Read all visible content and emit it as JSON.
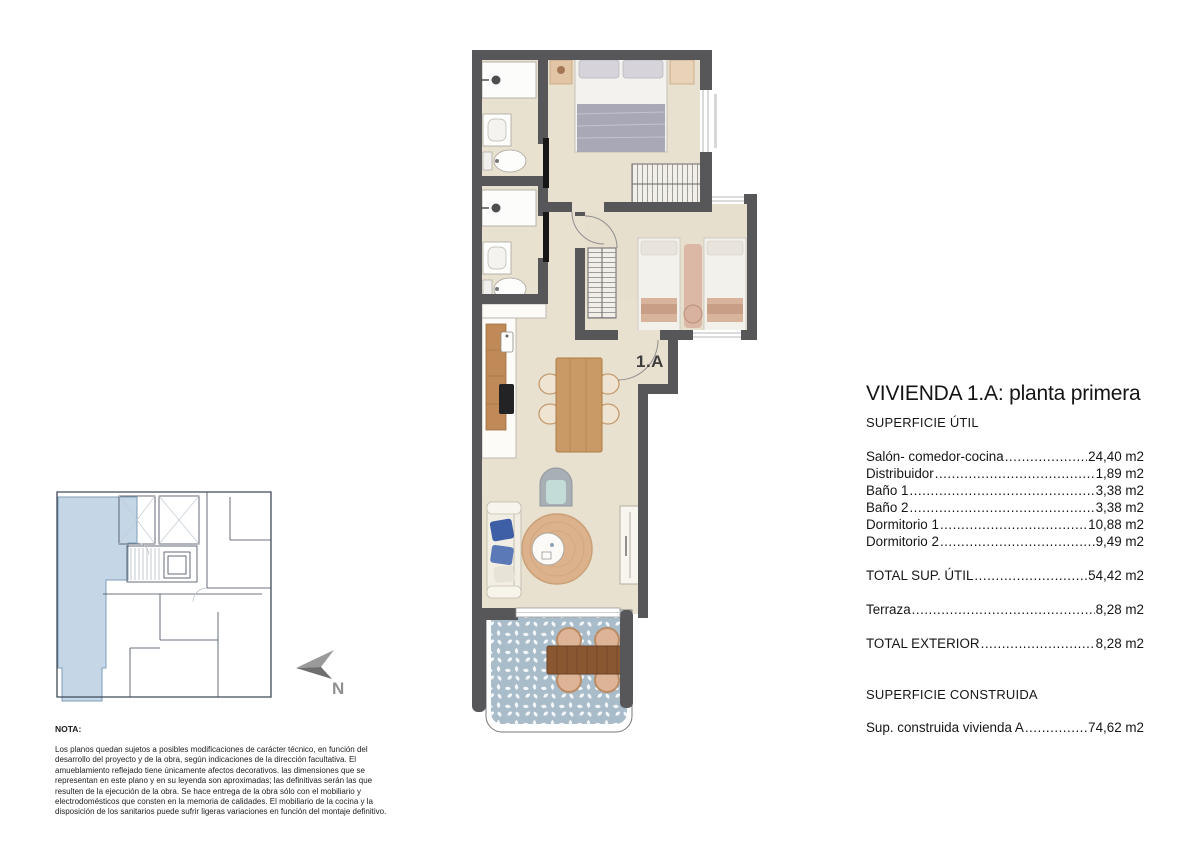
{
  "title": "VIVIENDA 1.A: planta primera",
  "superficie_util": {
    "heading": "SUPERFICIE ÚTIL",
    "rows": [
      {
        "label": "Salón- comedor-cocina",
        "value": "24,40 m2"
      },
      {
        "label": "Distribuidor",
        "value": "1,89 m2"
      },
      {
        "label": "Baño 1",
        "value": "3,38 m2"
      },
      {
        "label": "Baño 2",
        "value": "3,38 m2"
      },
      {
        "label": "Dormitorio 1",
        "value": "10,88 m2"
      },
      {
        "label": "Dormitorio 2",
        "value": "9,49 m2"
      }
    ],
    "total": {
      "label": "TOTAL SUP. ÚTIL",
      "value": "54,42 m2"
    }
  },
  "exterior": {
    "terraza": {
      "label": "Terraza",
      "value": "8,28 m2"
    },
    "total": {
      "label": "TOTAL EXTERIOR",
      "value": "8,28 m2"
    }
  },
  "construida": {
    "heading": "SUPERFICIE CONSTRUIDA",
    "row": {
      "label": "Sup. construida vivienda A",
      "value": "74,62 m2"
    }
  },
  "plan": {
    "unit_label": "1.A",
    "north_label": "N"
  },
  "colors": {
    "wall": "#57575a",
    "floor": "#e9e1d0",
    "terrace_tile": "#a9bcca",
    "highlight_unit": "#c5d7e7"
  },
  "note": {
    "heading": "NOTA:",
    "body": "Los planos quedan sujetos a posibles modificaciones de carácter técnico, en función del desarrollo del proyecto y de la obra, según indicaciones de la dirección facultativa. El amueblamiento reflejado tiene únicamente afectos decorativos. las dimensiones que se representan en este plano y en su leyenda son aproximadas; las definitivas serán las que resulten de la ejecución de la obra. Se hace entrega de la obra sólo con el mobiliario y electrodomésticos que consten en la memoria de calidades. El mobiliario de la cocina y la disposición de los sanitarios puede sufrir ligeras variaciones en función del montaje definitivo."
  }
}
